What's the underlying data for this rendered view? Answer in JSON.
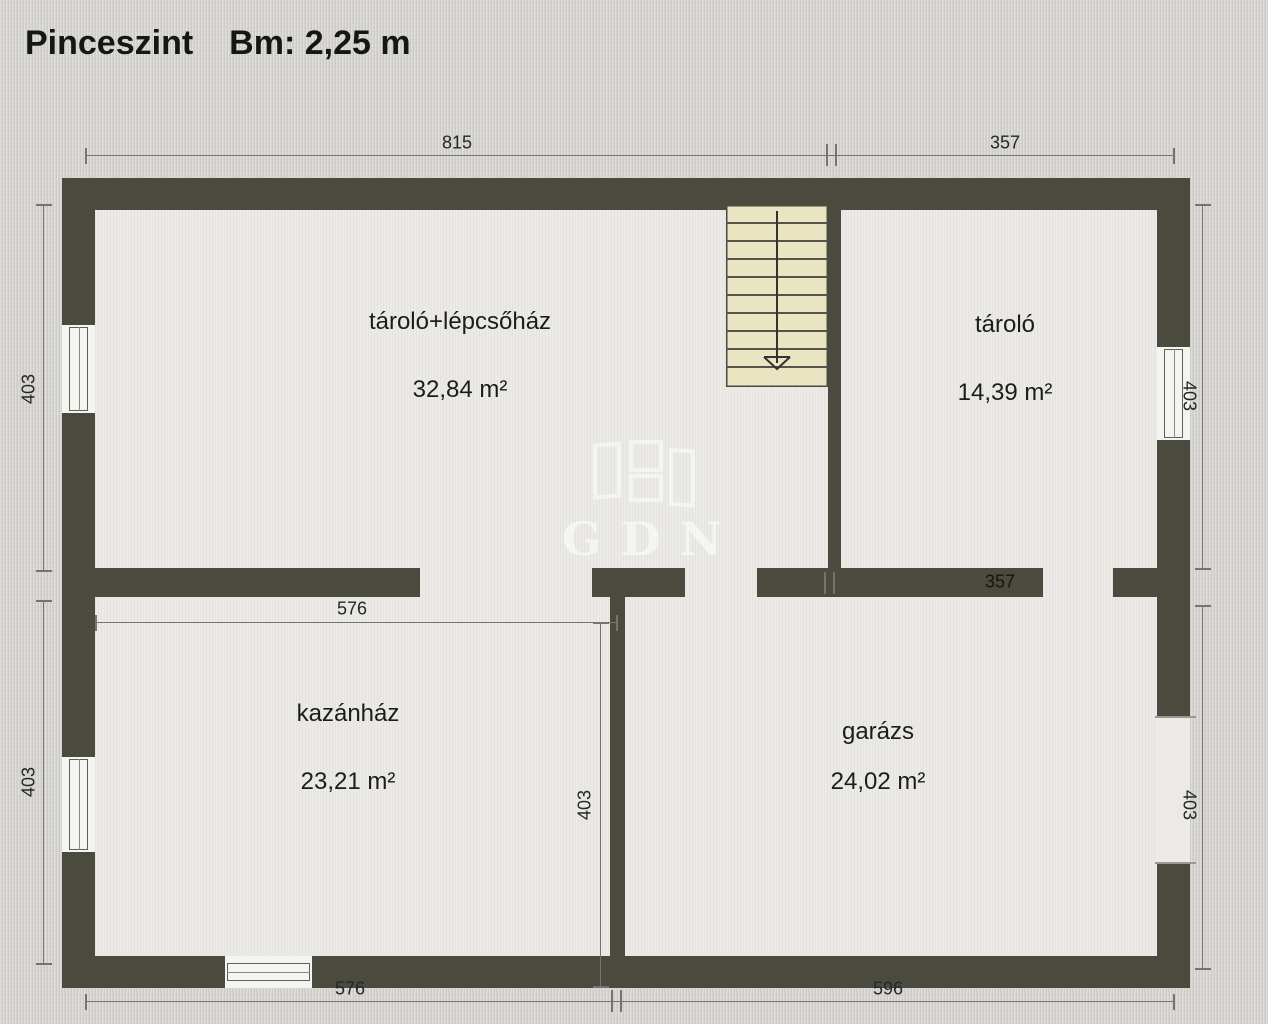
{
  "title": {
    "floor_name": "Pinceszint",
    "height_label": "Bm: 2,25 m"
  },
  "watermark": {
    "text": "GDN"
  },
  "rooms": [
    {
      "name": "tároló+lépcsőház",
      "area": "32,84 m²"
    },
    {
      "name": "tároló",
      "area": "14,39 m²"
    },
    {
      "name": "kazánház",
      "area": "23,21 m²"
    },
    {
      "name": "garázs",
      "area": "24,02 m²"
    }
  ],
  "dimensions": {
    "top_left": "815",
    "top_right": "357",
    "bottom_left": "576",
    "bottom_right": "596",
    "left_upper": "403",
    "left_lower": "403",
    "right_upper": "403",
    "right_lower": "403",
    "inner_width": "576",
    "inner_height": "403",
    "inner_wall": "357"
  },
  "colors": {
    "bg": "#d6d5d1",
    "floor": "#ebeae6",
    "wall": "#4b4a3e",
    "stair-fill": "#e9e5c2",
    "dim": "#75736f",
    "text": "#1c1c1c"
  }
}
